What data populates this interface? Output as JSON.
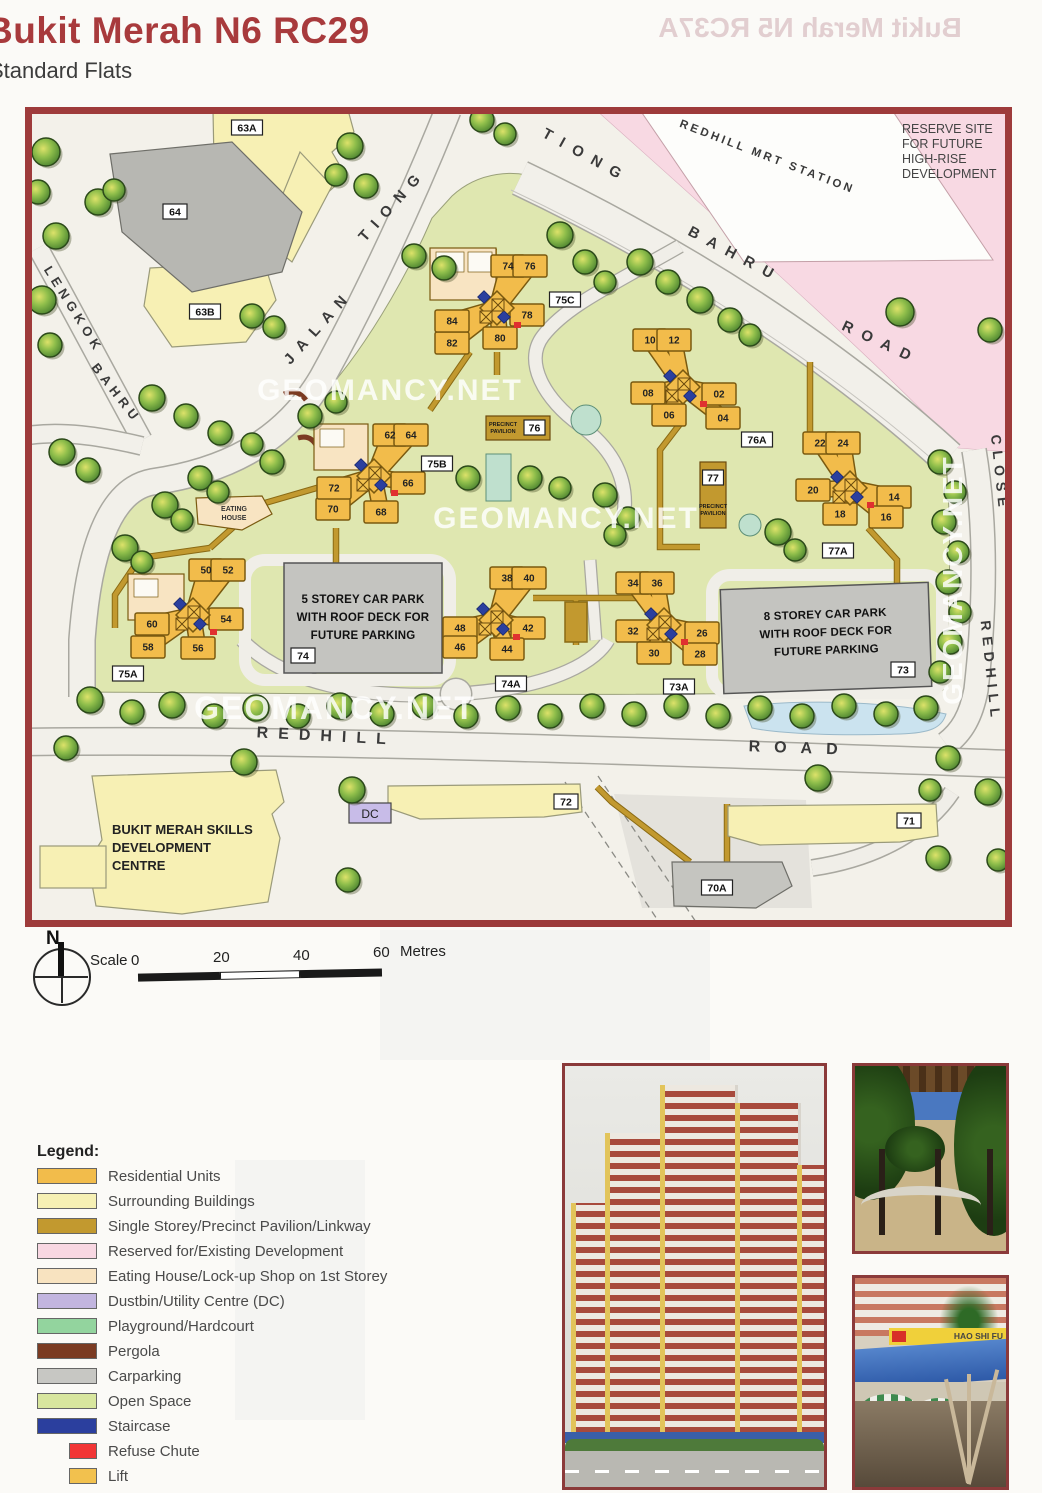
{
  "header": {
    "title": "Bukit Merah N6 RC29",
    "subtitle": "Standard Flats",
    "ghost": "Bukit Merah N5 RC37A"
  },
  "map": {
    "watermark": "GEOMANCY.NET",
    "mrt_label": "REDHILL MRT STATION",
    "reserve": {
      "l1": "RESERVE SITE",
      "l2": "FOR FUTURE",
      "l3": "HIGH-RISE",
      "l4": "DEVELOPMENT"
    },
    "roads": {
      "jalan": "JALAN",
      "jalan_tiong": "TIONG",
      "tbr_tiong": "TIONG",
      "tbr_bahru": "BAHRU",
      "tbr_road": "ROAD",
      "lengkok": "LENGKOK",
      "lengkok_bahru": "BAHRU",
      "close": "CLOSE",
      "redhill_close": "REDHILL",
      "redhill_s": "REDHILL",
      "road_s": "ROAD"
    },
    "carpark5": {
      "l1": "5 STOREY CAR PARK",
      "l2": "WITH ROOF DECK FOR",
      "l3": "FUTURE PARKING",
      "tag": "74"
    },
    "carpark8": {
      "l1": "8 STOREY CAR PARK",
      "l2": "WITH ROOF DECK FOR",
      "l3": "FUTURE PARKING",
      "tag": "73"
    },
    "pavilion76": {
      "l1": "PRECINCT",
      "l2": "PAVILION",
      "tag": "76"
    },
    "pavilion77": {
      "l1": "PRECINCT",
      "l2": "PAVILION",
      "tag": "77"
    },
    "eating": {
      "l1": "EATING",
      "l2": "HOUSE"
    },
    "skills": {
      "l1": "BUKIT MERAH SKILLS",
      "l2": "DEVELOPMENT",
      "l3": "CENTRE"
    },
    "dc_label": "DC",
    "boxes": [
      {
        "t": "63A",
        "x": 247,
        "y": 128
      },
      {
        "t": "64",
        "x": 175,
        "y": 212
      },
      {
        "t": "63B",
        "x": 205,
        "y": 312
      },
      {
        "t": "75C",
        "x": 565,
        "y": 300
      },
      {
        "t": "75B",
        "x": 437,
        "y": 464
      },
      {
        "t": "76A",
        "x": 757,
        "y": 440
      },
      {
        "t": "77A",
        "x": 838,
        "y": 551
      },
      {
        "t": "75A",
        "x": 128,
        "y": 674
      },
      {
        "t": "74",
        "x": 303,
        "y": 656
      },
      {
        "t": "74A",
        "x": 511,
        "y": 684
      },
      {
        "t": "73A",
        "x": 679,
        "y": 687
      },
      {
        "t": "73",
        "x": 903,
        "y": 670
      },
      {
        "t": "72",
        "x": 566,
        "y": 802
      },
      {
        "t": "71",
        "x": 909,
        "y": 821
      },
      {
        "t": "70A",
        "x": 717,
        "y": 888
      }
    ],
    "clusters": [
      {
        "id": "a",
        "cx": 497,
        "cy": 308,
        "units": [
          {
            "n": "74",
            "x": 508,
            "y": 266
          },
          {
            "n": "76",
            "x": 530,
            "y": 266
          },
          {
            "n": "78",
            "x": 527,
            "y": 315
          },
          {
            "n": "80",
            "x": 500,
            "y": 338
          },
          {
            "n": "82",
            "x": 452,
            "y": 343
          },
          {
            "n": "84",
            "x": 452,
            "y": 321
          }
        ]
      },
      {
        "id": "b",
        "cx": 683,
        "cy": 387,
        "units": [
          {
            "n": "10",
            "x": 650,
            "y": 340
          },
          {
            "n": "12",
            "x": 674,
            "y": 340
          },
          {
            "n": "08",
            "x": 648,
            "y": 393
          },
          {
            "n": "06",
            "x": 669,
            "y": 415
          },
          {
            "n": "02",
            "x": 719,
            "y": 394
          },
          {
            "n": "04",
            "x": 723,
            "y": 418
          }
        ]
      },
      {
        "id": "c",
        "cx": 850,
        "cy": 488,
        "units": [
          {
            "n": "22",
            "x": 820,
            "y": 443
          },
          {
            "n": "24",
            "x": 843,
            "y": 443
          },
          {
            "n": "20",
            "x": 813,
            "y": 490
          },
          {
            "n": "18",
            "x": 840,
            "y": 514
          },
          {
            "n": "14",
            "x": 894,
            "y": 497
          },
          {
            "n": "16",
            "x": 886,
            "y": 517
          }
        ]
      },
      {
        "id": "d",
        "cx": 193,
        "cy": 615,
        "units": [
          {
            "n": "50",
            "x": 206,
            "y": 570
          },
          {
            "n": "52",
            "x": 228,
            "y": 570
          },
          {
            "n": "54",
            "x": 226,
            "y": 619
          },
          {
            "n": "60",
            "x": 152,
            "y": 624
          },
          {
            "n": "58",
            "x": 148,
            "y": 647
          },
          {
            "n": "56",
            "x": 198,
            "y": 648
          }
        ]
      },
      {
        "id": "e",
        "cx": 374,
        "cy": 476,
        "units": [
          {
            "n": "62",
            "x": 390,
            "y": 435
          },
          {
            "n": "64",
            "x": 411,
            "y": 435
          },
          {
            "n": "66",
            "x": 408,
            "y": 483
          },
          {
            "n": "68",
            "x": 381,
            "y": 512
          },
          {
            "n": "70",
            "x": 333,
            "y": 509
          },
          {
            "n": "72",
            "x": 334,
            "y": 488
          }
        ]
      },
      {
        "id": "f",
        "cx": 496,
        "cy": 620,
        "units": [
          {
            "n": "38",
            "x": 507,
            "y": 578
          },
          {
            "n": "40",
            "x": 529,
            "y": 578
          },
          {
            "n": "42",
            "x": 528,
            "y": 628
          },
          {
            "n": "44",
            "x": 507,
            "y": 649
          },
          {
            "n": "48",
            "x": 460,
            "y": 628
          },
          {
            "n": "46",
            "x": 460,
            "y": 647
          }
        ]
      },
      {
        "id": "g",
        "cx": 664,
        "cy": 625,
        "units": [
          {
            "n": "34",
            "x": 633,
            "y": 583
          },
          {
            "n": "36",
            "x": 657,
            "y": 583
          },
          {
            "n": "32",
            "x": 633,
            "y": 631
          },
          {
            "n": "30",
            "x": 654,
            "y": 653
          },
          {
            "n": "26",
            "x": 702,
            "y": 633
          },
          {
            "n": "28",
            "x": 700,
            "y": 654
          }
        ]
      }
    ],
    "trees": [
      [
        46,
        152,
        14
      ],
      [
        38,
        192,
        12
      ],
      [
        56,
        236,
        13
      ],
      [
        42,
        300,
        14
      ],
      [
        50,
        345,
        12
      ],
      [
        98,
        202,
        13
      ],
      [
        114,
        190,
        11
      ],
      [
        350,
        146,
        13
      ],
      [
        366,
        186,
        12
      ],
      [
        336,
        175,
        11
      ],
      [
        414,
        256,
        12
      ],
      [
        444,
        268,
        12
      ],
      [
        252,
        316,
        12
      ],
      [
        274,
        327,
        11
      ],
      [
        152,
        398,
        13
      ],
      [
        186,
        416,
        12
      ],
      [
        220,
        433,
        12
      ],
      [
        252,
        444,
        11
      ],
      [
        310,
        416,
        12
      ],
      [
        336,
        402,
        11
      ],
      [
        482,
        120,
        12
      ],
      [
        505,
        134,
        11
      ],
      [
        560,
        235,
        13
      ],
      [
        585,
        262,
        12
      ],
      [
        605,
        282,
        11
      ],
      [
        640,
        262,
        13
      ],
      [
        668,
        282,
        12
      ],
      [
        700,
        300,
        13
      ],
      [
        730,
        320,
        12
      ],
      [
        750,
        335,
        11
      ],
      [
        900,
        312,
        14
      ],
      [
        990,
        330,
        12
      ],
      [
        940,
        462,
        12
      ],
      [
        955,
        492,
        11
      ],
      [
        944,
        522,
        12
      ],
      [
        958,
        552,
        11
      ],
      [
        948,
        582,
        12
      ],
      [
        960,
        612,
        11
      ],
      [
        950,
        642,
        12
      ],
      [
        940,
        672,
        11
      ],
      [
        530,
        478,
        12
      ],
      [
        560,
        488,
        11
      ],
      [
        605,
        495,
        12
      ],
      [
        628,
        518,
        11
      ],
      [
        468,
        478,
        12
      ],
      [
        615,
        535,
        11
      ],
      [
        778,
        532,
        13
      ],
      [
        795,
        550,
        11
      ],
      [
        62,
        452,
        13
      ],
      [
        88,
        470,
        12
      ],
      [
        125,
        548,
        13
      ],
      [
        142,
        562,
        11
      ],
      [
        165,
        505,
        13
      ],
      [
        182,
        520,
        11
      ],
      [
        200,
        478,
        12
      ],
      [
        218,
        492,
        11
      ],
      [
        272,
        462,
        12
      ],
      [
        90,
        700,
        13
      ],
      [
        132,
        712,
        12
      ],
      [
        172,
        705,
        13
      ],
      [
        214,
        716,
        12
      ],
      [
        256,
        708,
        13
      ],
      [
        298,
        716,
        12
      ],
      [
        340,
        706,
        13
      ],
      [
        382,
        714,
        12
      ],
      [
        424,
        706,
        12
      ],
      [
        466,
        716,
        12
      ],
      [
        508,
        708,
        12
      ],
      [
        550,
        716,
        12
      ],
      [
        592,
        706,
        12
      ],
      [
        634,
        714,
        12
      ],
      [
        676,
        706,
        12
      ],
      [
        718,
        716,
        12
      ],
      [
        760,
        708,
        12
      ],
      [
        802,
        716,
        12
      ],
      [
        844,
        706,
        12
      ],
      [
        886,
        714,
        12
      ],
      [
        926,
        708,
        12
      ],
      [
        66,
        748,
        12
      ],
      [
        244,
        762,
        13
      ],
      [
        352,
        790,
        13
      ],
      [
        818,
        778,
        13
      ],
      [
        948,
        758,
        12
      ],
      [
        988,
        792,
        13
      ],
      [
        938,
        858,
        12
      ],
      [
        998,
        860,
        11
      ],
      [
        348,
        880,
        12
      ],
      [
        930,
        790,
        11
      ]
    ]
  },
  "compass": {
    "label": "N"
  },
  "scalebar": {
    "label": "Scale",
    "t0": "0",
    "t20": "20",
    "t40": "40",
    "t60": "60",
    "unit": "Metres"
  },
  "legend": {
    "heading": "Legend:",
    "items": [
      {
        "label": "Residential Units",
        "color": "#F2BC4B",
        "type": "solid"
      },
      {
        "label": "Surrounding Buildings",
        "color": "#F6F0B4",
        "type": "solid"
      },
      {
        "label": "Single Storey/Precinct Pavilion/Linkway",
        "color": "#C2992F",
        "type": "solid"
      },
      {
        "label": "Reserved for/Existing Development",
        "color": "#F8D7E2",
        "type": "solid"
      },
      {
        "label": "Eating House/Lock-up Shop on 1st Storey",
        "color": "#F8E3C0",
        "type": "solid"
      },
      {
        "label": "Dustbin/Utility Centre (DC)",
        "color": "#C2B5DF",
        "type": "hatch"
      },
      {
        "label": "Playground/Hardcourt",
        "color": "#93D49E",
        "type": "hatch"
      },
      {
        "label": "Pergola",
        "color": "#7B3B22",
        "type": "solid"
      },
      {
        "label": "Carparking",
        "color": "#C7C7C3",
        "type": "hatch"
      },
      {
        "label": "Open Space",
        "color": "#D8E69E",
        "type": "solid"
      },
      {
        "label": "Staircase",
        "color": "#2B3F9E",
        "type": "solid"
      },
      {
        "label": "Refuse Chute",
        "color": "#F23535",
        "type": "narrow"
      },
      {
        "label": "Lift",
        "color": "#F2C14E",
        "type": "narrow-x"
      }
    ]
  },
  "photos": {
    "sign": "HAO SHI FU"
  }
}
